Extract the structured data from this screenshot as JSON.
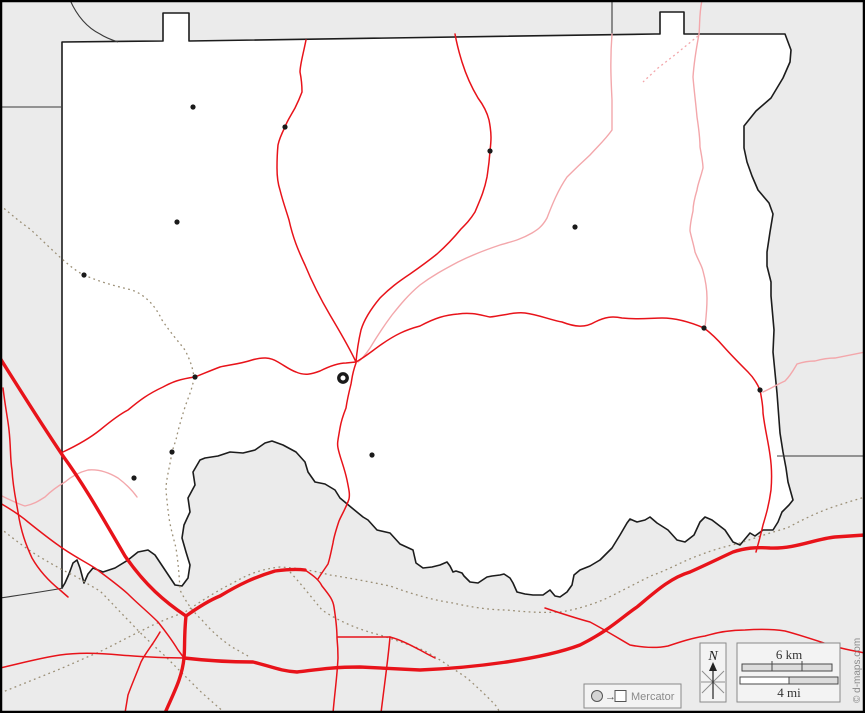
{
  "map": {
    "legend": {
      "north_label": "N",
      "scale_km_label": "6 km",
      "scale_mi_label": "4 mi",
      "projection_label": "Mercator",
      "copyright": "© d-maps.com"
    },
    "colors": {
      "background": "#ebebeb",
      "county_fill": "#ffffff",
      "boundary": "#1c1c1c",
      "neighbor_line": "#3a3a3a",
      "road_major": "#e8131a",
      "road_minor": "#e8131a",
      "road_tertiary": "#f3a7ab",
      "rail_dotted": "#9b8f76",
      "town_dot": "#1a1a1a",
      "legend_border": "#8a8a8a",
      "legend_text": "#333333",
      "muted_text": "#8a8a8a",
      "scalebar_fill": "#dcdcdc"
    },
    "towns": [
      [
        193,
        107
      ],
      [
        285,
        127
      ],
      [
        490,
        151
      ],
      [
        177,
        222
      ],
      [
        575,
        227
      ],
      [
        84,
        275
      ],
      [
        704,
        328
      ],
      [
        195,
        377
      ],
      [
        760,
        390
      ],
      [
        172,
        452
      ],
      [
        372,
        455
      ],
      [
        134,
        478
      ]
    ],
    "county_seat": {
      "x": 343,
      "y": 378
    }
  }
}
